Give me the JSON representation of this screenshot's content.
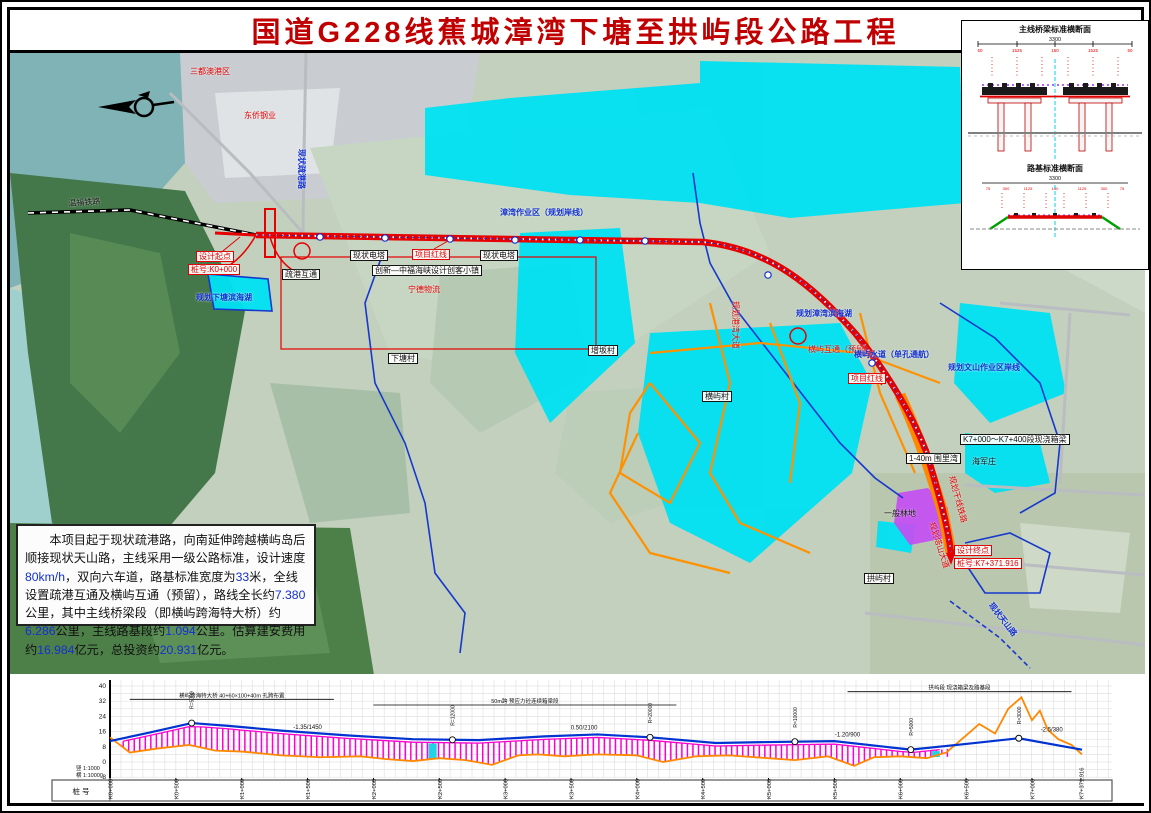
{
  "title": "国道G228线蕉城漳湾下塘至拱屿段公路工程",
  "description": {
    "text": "本项目起于现状疏港路，向南延伸跨越横屿岛后顺接现状天山路，主线采用一级公路标准，设计速度80km/h，双向六车道，路基标准宽度为33米，全线设置疏港互通及横屿互通（预留），路线全长约7.380公里，其中主线桥梁段（即横屿跨海特大桥）约6.286公里，主线路基段约1.094公里。估算建安费用约16.984亿元，总投资约20.931亿元。"
  },
  "colors": {
    "title_red": "#c00000",
    "route_red": "#e60000",
    "planned_orange": "#ff9100",
    "water_cyan": "#00e1f2",
    "boundary_blue": "#1638cc",
    "bridge_hatch": "#ff00cc",
    "farmland_purple": "#c44df2"
  },
  "map": {
    "labels": [
      {
        "text": "三都澳港区",
        "x": 180,
        "y": 14,
        "c": "red"
      },
      {
        "text": "东侨钢业",
        "x": 234,
        "y": 58,
        "c": "red"
      },
      {
        "text": "现状疏港路",
        "x": 296,
        "y": 96,
        "c": "blue",
        "rot": 90
      },
      {
        "text": "设计起点",
        "x": 186,
        "y": 198,
        "c": "red",
        "box": true
      },
      {
        "text": "桩号:K0+000",
        "x": 178,
        "y": 211,
        "c": "red",
        "box": true
      },
      {
        "text": "规划下塘滨海湖",
        "x": 186,
        "y": 240,
        "c": "blue"
      },
      {
        "text": "疏港互通",
        "x": 272,
        "y": 216,
        "c": "black",
        "box": true
      },
      {
        "text": "现状电塔",
        "x": 340,
        "y": 197,
        "c": "black",
        "box": true
      },
      {
        "text": "现状电塔",
        "x": 470,
        "y": 197,
        "c": "black",
        "box": true
      },
      {
        "text": "创新—中福海峡设计创客小镇",
        "x": 362,
        "y": 212,
        "c": "black",
        "box": true
      },
      {
        "text": "宁德物流",
        "x": 398,
        "y": 232,
        "c": "red"
      },
      {
        "text": "项目红线",
        "x": 402,
        "y": 196,
        "c": "red",
        "box": true
      },
      {
        "text": "漳湾作业区（规划岸线）",
        "x": 490,
        "y": 155,
        "c": "blue"
      },
      {
        "text": "下塘村",
        "x": 378,
        "y": 300,
        "c": "black",
        "box": true
      },
      {
        "text": "增坂村",
        "x": 578,
        "y": 292,
        "c": "black",
        "box": true
      },
      {
        "text": "横屿村",
        "x": 692,
        "y": 338,
        "c": "black",
        "box": true
      },
      {
        "text": "规划港湾大道",
        "x": 730,
        "y": 248,
        "c": "red",
        "rot": 90
      },
      {
        "text": "规划漳湾滨海湖",
        "x": 786,
        "y": 256,
        "c": "blue"
      },
      {
        "text": "横屿互通（预留）",
        "x": 798,
        "y": 292,
        "c": "red"
      },
      {
        "text": "横屿水道（单孔通航）",
        "x": 844,
        "y": 297,
        "c": "blue"
      },
      {
        "text": "项目红线",
        "x": 838,
        "y": 320,
        "c": "red",
        "box": true
      },
      {
        "text": "规划文山作业区岸线",
        "x": 938,
        "y": 310,
        "c": "blue"
      },
      {
        "text": "1-40m 围里湾",
        "x": 896,
        "y": 400,
        "c": "black",
        "box": true
      },
      {
        "text": "海军庄",
        "x": 962,
        "y": 404,
        "c": "black"
      },
      {
        "text": "K7+000～K7+400段现浇箱梁",
        "x": 950,
        "y": 381,
        "c": "black",
        "box": true
      },
      {
        "text": "规划干线铁路",
        "x": 946,
        "y": 422,
        "c": "red",
        "rot": 75
      },
      {
        "text": "一般林地",
        "x": 874,
        "y": 456,
        "c": "black"
      },
      {
        "text": "规划塔山大道",
        "x": 926,
        "y": 468,
        "c": "red",
        "rot": 72
      },
      {
        "text": "拱屿村",
        "x": 854,
        "y": 520,
        "c": "black",
        "box": true
      },
      {
        "text": "设计终点",
        "x": 944,
        "y": 492,
        "c": "red",
        "box": true
      },
      {
        "text": "桩号:K7+371.916",
        "x": 944,
        "y": 505,
        "c": "red",
        "box": true
      },
      {
        "text": "现状天山路",
        "x": 984,
        "y": 548,
        "c": "blue",
        "rot": 52
      },
      {
        "text": "温福铁路",
        "x": 58,
        "y": 146,
        "c": "black",
        "rot": -4
      }
    ]
  },
  "cross_sections": {
    "bridge_title": "主线桥梁标准横断面",
    "embankment_title": "路基标准横断面",
    "total_width": "3300",
    "bridge_dims": [
      "50",
      "1525",
      "150",
      "1525",
      "50"
    ],
    "emb_dims": [
      "75",
      "300",
      "1125",
      "150",
      "1125",
      "300",
      "75"
    ]
  },
  "chart_data": {
    "type": "line",
    "title": "路线纵断面图",
    "ylabel": "标高(m)",
    "y_ticks": [
      40,
      32,
      24,
      16,
      8,
      0,
      -8
    ],
    "ylim": [
      -10,
      44
    ],
    "x_max_km": 7.38,
    "grid": true,
    "scale_vertical": "竖 1:1000",
    "scale_horizontal": "横 1:10000",
    "row_header": "桩  号",
    "stations": [
      {
        "km": 0.0,
        "label": "K0+000"
      },
      {
        "km": 0.5,
        "label": "K0+500"
      },
      {
        "km": 1.0,
        "label": "K1+000"
      },
      {
        "km": 1.5,
        "label": "K1+500"
      },
      {
        "km": 2.0,
        "label": "K2+000"
      },
      {
        "km": 2.5,
        "label": "K2+500"
      },
      {
        "km": 3.0,
        "label": "K3+000"
      },
      {
        "km": 3.5,
        "label": "K3+500"
      },
      {
        "km": 4.0,
        "label": "K4+000"
      },
      {
        "km": 4.5,
        "label": "K4+500"
      },
      {
        "km": 5.0,
        "label": "K5+000"
      },
      {
        "km": 5.5,
        "label": "K5+500"
      },
      {
        "km": 6.0,
        "label": "K6+000"
      },
      {
        "km": 6.5,
        "label": "K6+500"
      },
      {
        "km": 7.0,
        "label": "K7+000"
      },
      {
        "km": 7.372,
        "label": "K7+371.916"
      }
    ],
    "series": [
      {
        "name": "设计线",
        "color": "#0033d0",
        "km": [
          0,
          0.3,
          0.62,
          0.9,
          1.3,
          1.8,
          2.3,
          2.8,
          3.3,
          3.7,
          4.1,
          4.6,
          5.0,
          5.5,
          6.08,
          6.5,
          6.9,
          7.38
        ],
        "elev": [
          11,
          15.5,
          20.5,
          19,
          16.5,
          14,
          12,
          11.5,
          13.5,
          14.5,
          13,
          10,
          10.5,
          11,
          6.5,
          9.5,
          12.5,
          6.5
        ]
      },
      {
        "name": "地面线",
        "color": "#ff8800",
        "km": [
          0,
          0.15,
          0.35,
          0.6,
          0.8,
          1.0,
          1.3,
          1.6,
          1.9,
          2.1,
          2.3,
          2.5,
          2.7,
          2.9,
          3.1,
          3.25,
          3.45,
          3.7,
          4.0,
          4.2,
          4.45,
          4.7,
          5.0,
          5.2,
          5.45,
          5.65,
          5.8,
          6.0,
          6.2,
          6.35,
          6.5,
          6.6,
          6.72,
          6.82,
          6.92,
          7.0,
          7.06,
          7.12,
          7.2,
          7.3,
          7.38
        ],
        "elev": [
          13,
          5,
          7,
          9,
          6,
          5.5,
          3.5,
          2.5,
          3,
          1.5,
          0.5,
          2,
          1,
          -1.5,
          3.5,
          4,
          3,
          4,
          3.5,
          0,
          3,
          3.5,
          2,
          1,
          3,
          -2,
          2.5,
          3,
          2,
          5,
          14,
          20,
          15,
          28,
          34,
          22,
          27,
          17,
          12,
          9,
          4
        ]
      }
    ],
    "bridge": {
      "name": "横屿跨海特大桥（桥梁段约6.286km）",
      "start_km": 0.1,
      "end_km": 6.39,
      "hatch_color": "#ff00cc"
    },
    "channels_km": [
      2.45,
      6.27
    ],
    "vc_points": [
      {
        "km": 0.62,
        "label": "R=5000"
      },
      {
        "km": 2.6,
        "label": "R=12000"
      },
      {
        "km": 4.1,
        "label": "R=20000"
      },
      {
        "km": 5.2,
        "label": "R=10000"
      },
      {
        "km": 6.08,
        "label": "R=5000"
      },
      {
        "km": 6.9,
        "label": "R=3000"
      }
    ],
    "grade_labels": [
      {
        "km": 1.5,
        "elev": 17.5,
        "text": "-1.35/1450"
      },
      {
        "km": 3.6,
        "elev": 17.0,
        "text": "0.50/2100"
      },
      {
        "km": 5.6,
        "elev": 13.5,
        "text": "-1.20/900"
      },
      {
        "km": 7.15,
        "elev": 16.0,
        "text": "-2.5/380"
      }
    ],
    "notes": [
      {
        "km_start": 0.15,
        "km_end": 1.7,
        "elev": 33,
        "text": "横屿跨海特大桥 40+60×100+40m 孔跨布置"
      },
      {
        "km_start": 2.0,
        "km_end": 4.3,
        "elev": 30,
        "text": "50m跨 预应力砼连续箱梁段"
      },
      {
        "km_start": 5.6,
        "km_end": 7.3,
        "elev": 37,
        "text": "拱屿段 现浇箱梁及路基段"
      }
    ]
  }
}
